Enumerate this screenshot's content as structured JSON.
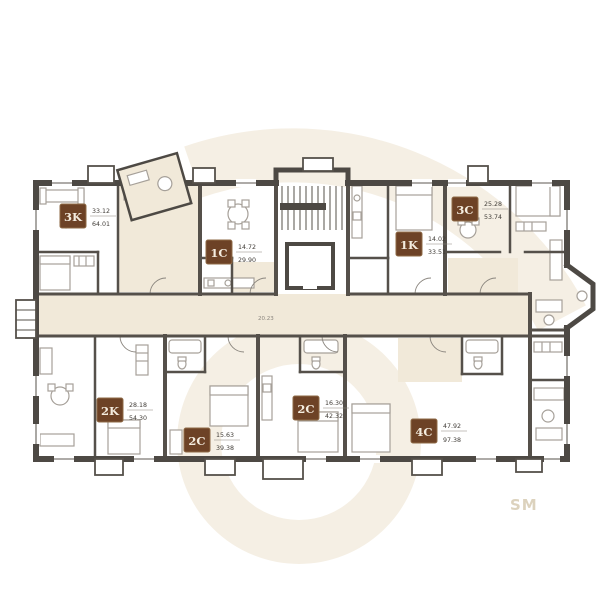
{
  "watermark": {
    "logo_text": "SM",
    "color": "#f5efe4",
    "text_color": "#dcd2bd"
  },
  "plan": {
    "corridor_area": "20.23",
    "units": [
      {
        "code": "3K",
        "living_area": "33.12",
        "total_area": "64.01"
      },
      {
        "code": "1C",
        "living_area": "14.72",
        "total_area": "29.90"
      },
      {
        "code": "3C",
        "living_area": "25.28",
        "total_area": "53.74"
      },
      {
        "code": "1K",
        "living_area": "14.02",
        "total_area": "33.51"
      },
      {
        "code": "2K",
        "living_area": "28.18",
        "total_area": "54.30"
      },
      {
        "code": "2C",
        "living_area": "15.63",
        "total_area": "39.38"
      },
      {
        "code": "2C",
        "living_area": "16.30",
        "total_area": "42.32"
      },
      {
        "code": "4C",
        "living_area": "47.92",
        "total_area": "97.38"
      }
    ],
    "colors": {
      "wall": "#4d4944",
      "partition": "#55504a",
      "furniture": "#a6a099",
      "corridor": "#f1e9d9",
      "badge_bg": "#6d4226",
      "badge_border": "#8f6b47",
      "badge_text": "#f4ecdf",
      "window": "#7d7974"
    }
  }
}
